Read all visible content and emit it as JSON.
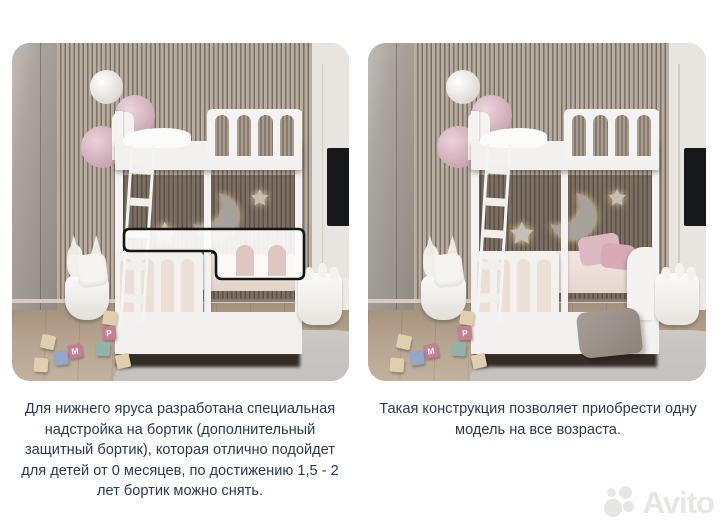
{
  "captions": {
    "left": "Для нижнего яруса разработана специальная\nнадстройка на бортик (дополнительный\nзащитный бортик), которая отлично подойдет\nдля детей от 0 месяцев, по достижению 1,5 - 2\nлет бортик можно снять.",
    "right": "Такая конструкция позволяет приобрести одну\nмодель на все возраста."
  },
  "watermark": {
    "brand": "Avito"
  },
  "blocks": {
    "letters": [
      "Р",
      "М"
    ]
  },
  "colors": {
    "caption_text": "#2b3950",
    "highlight_outline": "#161616",
    "glow": "#ffe3a4",
    "pink_accent": "#dcb8c2",
    "watermark": "#e8e6e4"
  }
}
